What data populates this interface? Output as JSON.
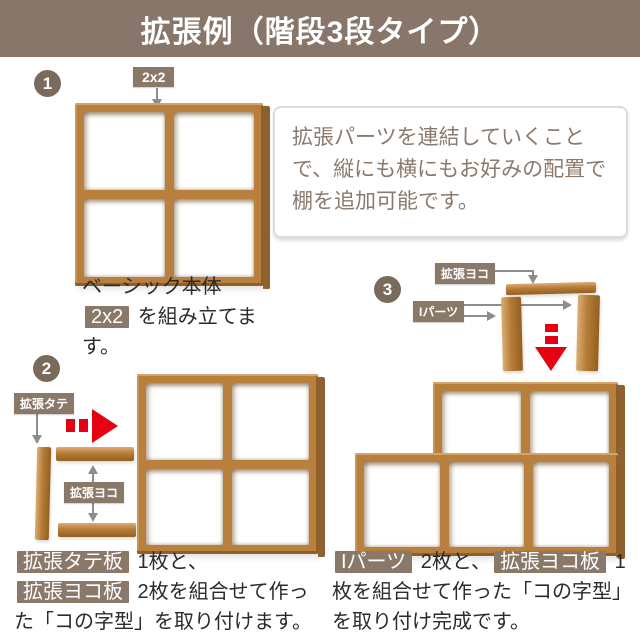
{
  "header": {
    "title": "拡張例（階段3段タイプ）"
  },
  "intro_box": {
    "text": "拡張パーツを連結していくことで、縦にも横にもお好みの配置で棚を追加可能です。"
  },
  "steps": [
    {
      "number": "1",
      "part_label": "2x2",
      "caption": [
        {
          "t": "ベーシック本体\n",
          "b": false
        },
        {
          "t": "2x2",
          "b": true
        },
        {
          "t": " を組み立てます。",
          "b": false
        }
      ]
    },
    {
      "number": "2",
      "labels": {
        "tate": "拡張タテ",
        "yoko": "拡張ヨコ"
      },
      "caption": [
        {
          "t": "拡張タテ板",
          "b": true
        },
        {
          "t": " 1枚と、",
          "b": false
        },
        {
          "t": "拡張ヨコ板",
          "b": true
        },
        {
          "t": " 2枚を組合せて作った「コの字型」を取り付けます。",
          "b": false
        }
      ]
    },
    {
      "number": "3",
      "labels": {
        "yoko": "拡張ヨコ",
        "ipart": "Iパーツ"
      },
      "caption": [
        {
          "t": "Iパーツ",
          "b": true
        },
        {
          "t": " 2枚と、",
          "b": false
        },
        {
          "t": "拡張ヨコ板",
          "b": true
        },
        {
          "t": " 1枚を組合せて作った「コの字型」を取り付け完成です。",
          "b": false
        }
      ]
    }
  ],
  "icons": {
    "down_arrow": "↓",
    "up_down_arrow": "↕",
    "right_arrow": "→",
    "red_right_arrow": "➡",
    "red_down_arrow": "⬇"
  },
  "colors": {
    "header_bg": "#877669",
    "badge_bg": "#8a7868",
    "step_circle_bg": "#796a5c",
    "wood_front": "#b97f3c",
    "wood_light": "#d6a468",
    "wood_dark": "#8d5f29",
    "accent_red": "#e50012",
    "info_text": "#8b7a6c",
    "caption_text": "#2b2b2b",
    "arrow_gray": "#8d8d8d"
  }
}
